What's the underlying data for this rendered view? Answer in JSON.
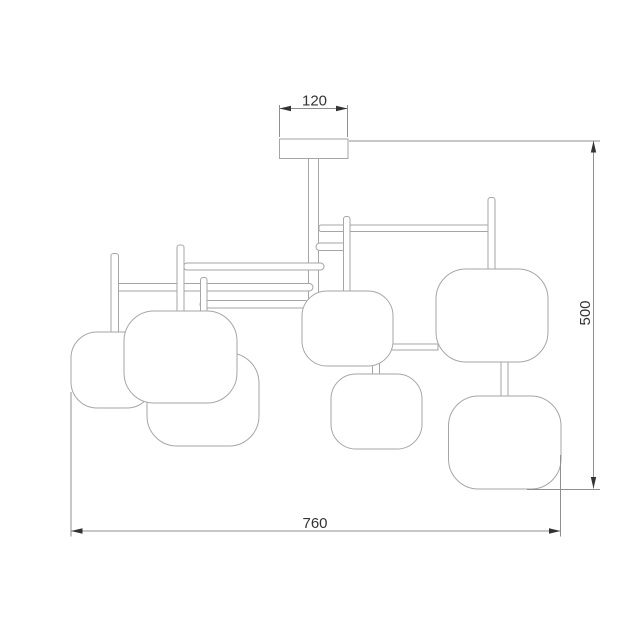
{
  "drawing": {
    "type": "technical-dimension-drawing",
    "subject": "ceiling chandelier with 7 rounded-square shades, front elevation",
    "shade_count": 7,
    "colors": {
      "background": "#ffffff",
      "outline": "#a6a6a6",
      "dimension": "#8f8f8f",
      "text": "#333333"
    },
    "dimensions": {
      "canopy_width": {
        "value": "120"
      },
      "overall_height": {
        "value": "500"
      },
      "overall_width": {
        "value": "760"
      }
    }
  }
}
